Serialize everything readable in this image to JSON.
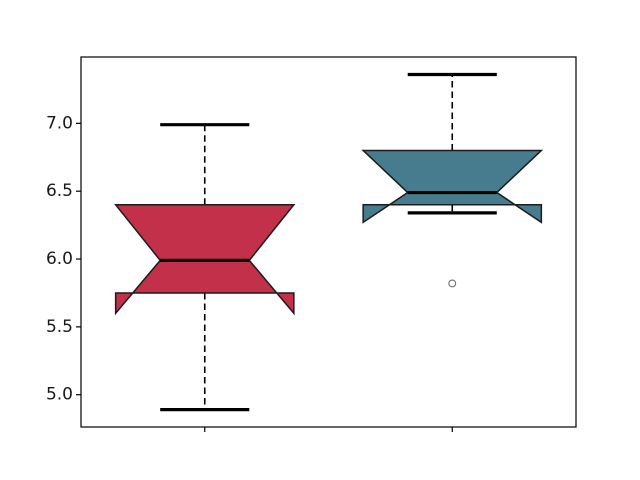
{
  "figure": {
    "width": 640,
    "height": 480,
    "background": "#ffffff"
  },
  "axes": {
    "px": {
      "left": 81,
      "top": 57,
      "width": 495,
      "height": 370
    },
    "face_color": "#ffffff",
    "spine_color": "#000000",
    "spine_width": 1.2,
    "tick_color": "#000000",
    "tick_length": 5,
    "tick_width": 1.2,
    "label_color": "#1a1a1a",
    "label_font_size": 17,
    "label_pad": 8
  },
  "chart_data": {
    "type": "boxplot",
    "notched": true,
    "orientation": "vertical",
    "title": "",
    "xlabel": "",
    "ylabel": "",
    "legend": null,
    "grid": false,
    "xlim": [
      0.5,
      2.5
    ],
    "ylim": [
      4.762,
      7.489
    ],
    "ytick_values": [
      7.0,
      6.5,
      6.0,
      5.5,
      5.0
    ],
    "ytick_labels": [
      "7.0",
      "6.5",
      "6.0",
      "5.5",
      "5.0"
    ],
    "xtick_positions": [
      1,
      2
    ],
    "xtick_labels": [
      "",
      ""
    ],
    "box_width": 0.72,
    "cap_span": 0.36,
    "notch_span": 0.36,
    "boxes": [
      {
        "name": "box-1",
        "position": 1,
        "whislo": 4.89,
        "q1": 5.75,
        "med": 5.99,
        "q3": 6.4,
        "whishi": 6.99,
        "cilo": 5.6,
        "cihi": 6.4,
        "fliers": [],
        "fill_color": "#C33049"
      },
      {
        "name": "box-2",
        "position": 2,
        "whislo": 6.34,
        "q1": 6.4,
        "med": 6.49,
        "q3": 6.8,
        "whishi": 7.36,
        "cilo": 6.27,
        "cihi": 6.8,
        "fliers": [
          5.82
        ],
        "fill_color": "#467C8D"
      }
    ],
    "style": {
      "edge_color": "#1c1c1c",
      "edge_width": 1.5,
      "median_color": "#000000",
      "median_stroke_width": 3.2,
      "whisker_color": "#000000",
      "whisker_stroke_width": 1.6,
      "whisker_dash": "6.5,4",
      "cap_color": "#000000",
      "cap_stroke_width": 3.2,
      "flier_edge_color": "#6e6e6e",
      "flier_stroke_width": 1.1,
      "flier_radius": 3.4
    }
  }
}
